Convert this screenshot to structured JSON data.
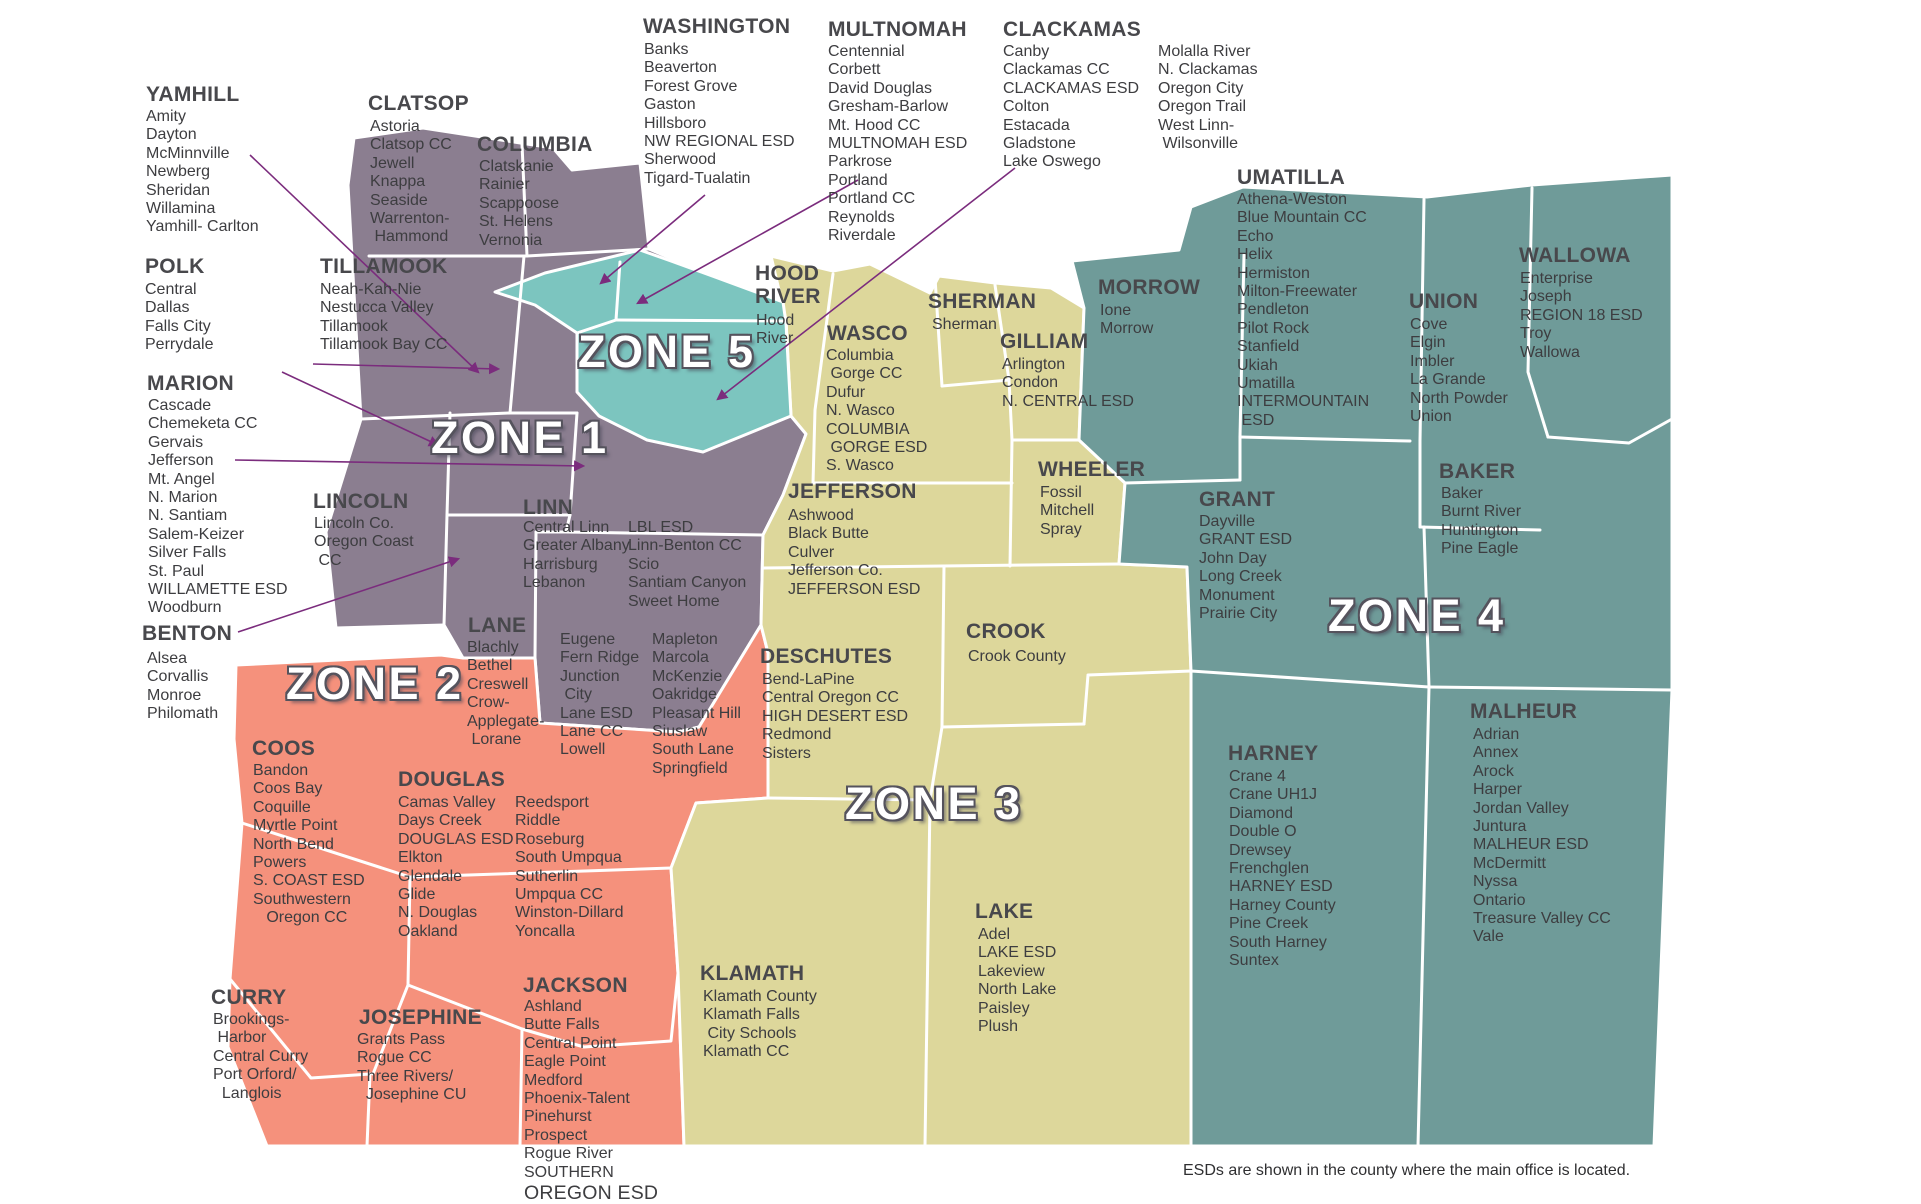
{
  "footnote": "ESDs are shown in the county where the main office is located.",
  "zones": [
    {
      "id": "zone-1",
      "label": "ZONE 1",
      "color": "#8b7e90"
    },
    {
      "id": "zone-2",
      "label": "ZONE 2",
      "color": "#f5917c"
    },
    {
      "id": "zone-3",
      "label": "ZONE 3",
      "color": "#ddd79b"
    },
    {
      "id": "zone-4",
      "label": "ZONE 4",
      "color": "#6f9b99"
    },
    {
      "id": "zone-5",
      "label": "ZONE 5",
      "color": "#7cc5bf"
    }
  ],
  "arrow_color": "#7b2c7d",
  "border_color": "#ffffff",
  "counties": [
    {
      "id": "clatsop",
      "zone": "zone-1",
      "name": "CLATSOP",
      "columns": [
        [
          "Astoria",
          "Clatsop CC",
          "Jewell",
          "Knappa",
          "Seaside",
          "Warrenton-",
          " Hammond"
        ]
      ]
    },
    {
      "id": "columbia",
      "zone": "zone-1",
      "name": "COLUMBIA",
      "columns": [
        [
          "Clatskanie",
          "Rainier",
          "Scappoose",
          "St. Helens",
          "Vernonia"
        ]
      ]
    },
    {
      "id": "washington",
      "zone": "zone-5",
      "name": "WASHINGTON",
      "columns": [
        [
          "Banks",
          "Beaverton",
          "Forest Grove",
          "Gaston",
          "Hillsboro",
          "NW REGIONAL ESD",
          "Sherwood",
          "Tigard-Tualatin"
        ]
      ]
    },
    {
      "id": "multnomah",
      "zone": "zone-5",
      "name": "MULTNOMAH",
      "columns": [
        [
          "Centennial",
          "Corbett",
          "David Douglas",
          "Gresham-Barlow",
          "Mt. Hood CC",
          "MULTNOMAH ESD",
          "Parkrose",
          "Portland",
          "Portland CC",
          "Reynolds",
          "Riverdale"
        ]
      ]
    },
    {
      "id": "clackamas",
      "zone": "zone-5",
      "name": "CLACKAMAS",
      "columns": [
        [
          "Canby",
          "Clackamas CC",
          "CLACKAMAS ESD",
          "Colton",
          "Estacada",
          "Gladstone",
          "Lake Oswego"
        ],
        [
          "Molalla River",
          "N. Clackamas",
          "Oregon City",
          "Oregon Trail",
          "West Linn-",
          " Wilsonville"
        ]
      ]
    },
    {
      "id": "yamhill",
      "zone": "zone-1",
      "name": "YAMHILL",
      "columns": [
        [
          "Amity",
          "Dayton",
          "McMinnville",
          "Newberg",
          "Sheridan",
          "Willamina",
          "Yamhill- Carlton"
        ]
      ]
    },
    {
      "id": "polk",
      "zone": "zone-1",
      "name": "POLK",
      "columns": [
        [
          "Central",
          "Dallas",
          "Falls City",
          "Perrydale"
        ]
      ]
    },
    {
      "id": "marion",
      "zone": "zone-1",
      "name": "MARION",
      "columns": [
        [
          "Cascade",
          "Chemeketa CC",
          "Gervais",
          "Jefferson",
          "Mt. Angel",
          "N. Marion",
          "N. Santiam",
          "Salem-Keizer",
          "Silver Falls",
          "St. Paul",
          "WILLAMETTE ESD",
          "Woodburn"
        ]
      ]
    },
    {
      "id": "benton",
      "zone": "zone-1",
      "name": "BENTON",
      "columns": [
        [
          "Alsea",
          "Corvallis",
          "Monroe",
          "Philomath"
        ]
      ]
    },
    {
      "id": "tillamook",
      "zone": "zone-1",
      "name": "TILLAMOOK",
      "columns": [
        [
          "Neah-Kah-Nie",
          "Nestucca Valley",
          "Tillamook",
          "Tillamook Bay CC"
        ]
      ]
    },
    {
      "id": "lincoln",
      "zone": "zone-1",
      "name": "LINCOLN",
      "columns": [
        [
          "Lincoln Co.",
          "Oregon Coast",
          " CC"
        ]
      ]
    },
    {
      "id": "linn",
      "zone": "zone-1",
      "name": "LINN",
      "columns": [
        [
          "Central Linn",
          "Greater Albany",
          "Harrisburg",
          "Lebanon"
        ],
        [
          "LBL ESD",
          "Linn-Benton CC",
          "Scio",
          "Santiam Canyon",
          "Sweet Home"
        ]
      ]
    },
    {
      "id": "hoodriver",
      "zone": "zone-3",
      "name": "HOOD\nRIVER",
      "columns": [
        [
          "Hood",
          "River"
        ]
      ]
    },
    {
      "id": "wasco",
      "zone": "zone-3",
      "name": "WASCO",
      "columns": [
        [
          "Columbia",
          " Gorge CC",
          "Dufur",
          "N. Wasco",
          "COLUMBIA",
          " GORGE ESD",
          "S. Wasco"
        ]
      ]
    },
    {
      "id": "sherman",
      "zone": "zone-3",
      "name": "SHERMAN",
      "columns": [
        [
          "Sherman"
        ]
      ]
    },
    {
      "id": "gilliam",
      "zone": "zone-3",
      "name": "GILLIAM",
      "columns": [
        [
          "Arlington",
          "Condon",
          "N. CENTRAL ESD"
        ]
      ]
    },
    {
      "id": "morrow",
      "zone": "zone-4",
      "name": "MORROW",
      "columns": [
        [
          "Ione",
          "Morrow"
        ]
      ]
    },
    {
      "id": "umatilla",
      "zone": "zone-4",
      "name": "UMATILLA",
      "columns": [
        [
          "Athena-Weston",
          "Blue Mountain CC",
          "Echo",
          "Helix",
          "Hermiston",
          "Milton-Freewater",
          "Pendleton",
          "Pilot Rock",
          "Stanfield",
          "Ukiah",
          "Umatilla",
          "INTERMOUNTAIN",
          " ESD"
        ]
      ]
    },
    {
      "id": "union",
      "zone": "zone-4",
      "name": "UNION",
      "columns": [
        [
          "Cove",
          "Elgin",
          "Imbler",
          "La Grande",
          "North Powder",
          "Union"
        ]
      ]
    },
    {
      "id": "wallowa",
      "zone": "zone-4",
      "name": "WALLOWA",
      "columns": [
        [
          "Enterprise",
          "Joseph",
          "REGION 18 ESD",
          "Troy",
          "Wallowa"
        ]
      ]
    },
    {
      "id": "wheeler",
      "zone": "zone-3",
      "name": "WHEELER",
      "columns": [
        [
          "Fossil",
          "Mitchell",
          "Spray"
        ]
      ]
    },
    {
      "id": "jeffer son",
      "zone": "zone-3",
      "name": "JEFFERSON",
      "columns": [
        [
          "Ashwood",
          "Black Butte",
          "Culver",
          "Jefferson Co.",
          "JEFFERSON ESD"
        ]
      ]
    },
    {
      "id": "grant",
      "zone": "zone-4",
      "name": "GRANT",
      "columns": [
        [
          "Dayville",
          "GRANT ESD",
          "John Day",
          "Long Creek",
          "Monument",
          "Prairie City"
        ]
      ]
    },
    {
      "id": "baker",
      "zone": "zone-4",
      "name": "BAKER",
      "columns": [
        [
          "Baker",
          "Burnt River",
          "Huntington",
          "Pine Eagle"
        ]
      ]
    },
    {
      "id": "crook",
      "zone": "zone-3",
      "name": "CROOK",
      "columns": [
        [
          "Crook County"
        ]
      ]
    },
    {
      "id": "deschutes",
      "zone": "zone-3",
      "name": "DESCHUTES",
      "columns": [
        [
          "Bend-LaPine",
          "Central Oregon CC",
          "HIGH DESERT ESD",
          "Redmond",
          "Sisters"
        ]
      ]
    },
    {
      "id": "lane",
      "zone": "zone-2",
      "name": "LANE",
      "columns": [
        [
          "Blachly",
          "Bethel",
          "Creswell",
          "Crow-",
          "Applegate-",
          " Lorane"
        ],
        [
          "Eugene",
          "Fern Ridge",
          "Junction",
          " City",
          "Lane ESD",
          "Lane CC",
          "Lowell"
        ],
        [
          "Mapleton",
          "Marcola",
          "McKenzie",
          "Oakridge",
          "Pleasant Hill",
          "Siuslaw",
          "South Lane",
          "Springfield"
        ]
      ]
    },
    {
      "id": "coos",
      "zone": "zone-2",
      "name": "COOS",
      "columns": [
        [
          "Bandon",
          "Coos Bay",
          "Coquille",
          "Myrtle Point",
          "North Bend",
          "Powers",
          "S. COAST ESD",
          "Southwestern",
          "   Oregon CC"
        ]
      ]
    },
    {
      "id": "douglas",
      "zone": "zone-2",
      "name": "DOUGLAS",
      "columns": [
        [
          "Camas Valley",
          "Days Creek",
          "DOUGLAS ESD",
          "Elkton",
          "Glendale",
          "Glide",
          "N. Douglas",
          "Oakland"
        ],
        [
          "Reedsport",
          "Riddle",
          "Roseburg",
          "South Umpqua",
          "Sutherlin",
          "Umpqua CC",
          "Winston-Dillard",
          "Yoncalla"
        ]
      ]
    },
    {
      "id": "curry",
      "zone": "zone-2",
      "name": "CURRY",
      "columns": [
        [
          "Brookings-",
          " Harbor",
          "Central Curry",
          "Port Orford/",
          "  Langlois"
        ]
      ]
    },
    {
      "id": "josephine",
      "zone": "zone-2",
      "name": "JOSEPHINE",
      "columns": [
        [
          "Grants Pass",
          "Rogue CC",
          "Three Rivers/",
          "  Josephine CU"
        ]
      ]
    },
    {
      "id": "jackson",
      "zone": "zone-2",
      "name": "JACKSON",
      "columns": [
        [
          "Ashland",
          "Butte Falls",
          "Central Point",
          "Eagle Point",
          "Medford",
          "Phoenix-Talent",
          "Pinehurst",
          "Prospect",
          "Rogue River",
          "SOUTHERN",
          "OREGON ESD"
        ]
      ]
    },
    {
      "id": "klamath",
      "zone": "zone-3",
      "name": "KLAMATH",
      "columns": [
        [
          "Klamath County",
          "Klamath Falls",
          " City Schools",
          "Klamath CC"
        ]
      ]
    },
    {
      "id": "lake",
      "zone": "zone-3",
      "name": "LAKE",
      "columns": [
        [
          "Adel",
          "LAKE ESD",
          "Lakeview",
          "North Lake",
          "Paisley",
          "Plush"
        ]
      ]
    },
    {
      "id": "harney",
      "zone": "zone-4",
      "name": "HARNEY",
      "columns": [
        [
          "Crane 4",
          "Crane UH1J",
          "Diamond",
          "Double O",
          "Drewsey",
          "Frenchglen",
          "HARNEY ESD",
          "Harney County",
          "Pine Creek",
          "South Harney",
          "Suntex"
        ]
      ]
    },
    {
      "id": "malheur",
      "zone": "zone-4",
      "name": "MALHEUR",
      "columns": [
        [
          "Adrian",
          "Annex",
          "Arock",
          "Harper",
          "Jordan Valley",
          "Juntura",
          "MALHEUR ESD",
          "McDermitt",
          "Nyssa",
          "Ontario",
          "Treasure Valley CC",
          "Vale"
        ]
      ]
    }
  ]
}
